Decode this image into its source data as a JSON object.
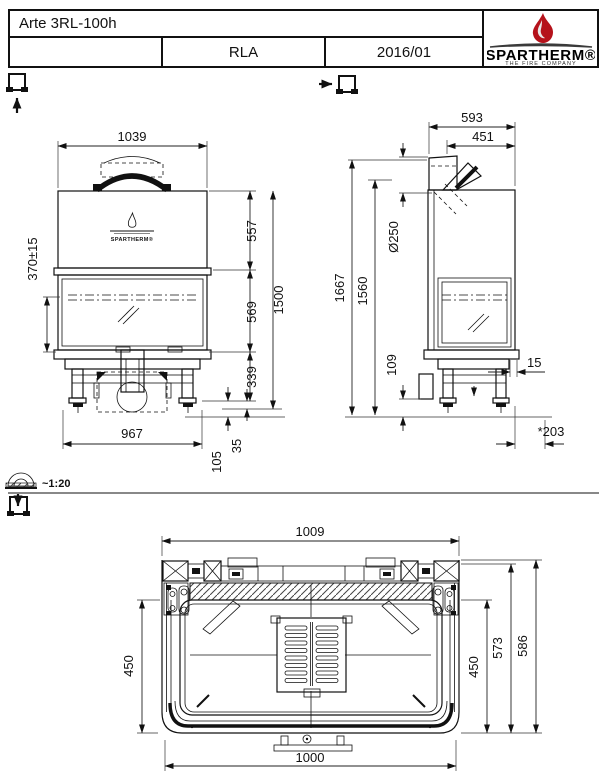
{
  "title_block": {
    "model": "Arte 3RL-100h",
    "revision": "",
    "code": "RLA",
    "date": "2016/01",
    "logo": {
      "brand": "SPARTHERM®",
      "tagline": "THE FIRE COMPANY"
    }
  },
  "scale_note": "~1:20",
  "front_view": {
    "logo_text": "SPARTHERM®",
    "dims": {
      "width_top": "1039",
      "firebed_height": "370±15",
      "hood_height": "557",
      "door_height": "569",
      "base_height": "339",
      "total_height": "1500",
      "foot_adjust": "35",
      "base_clearance": "105",
      "base_width": "967"
    }
  },
  "side_view": {
    "dims": {
      "depth_total": "593",
      "depth_front": "451",
      "flue_diameter": "Ø250",
      "height_flue_top": "1667",
      "height_flue_center": "1560",
      "rear_clearance": "109",
      "glass_offset": "15",
      "front_projection": "*203"
    }
  },
  "top_view": {
    "dims": {
      "width_body": "1009",
      "glass_depth_left": "450",
      "glass_depth_right": "450",
      "depth_inner": "573",
      "depth_total": "586",
      "width_front": "1000"
    }
  }
}
